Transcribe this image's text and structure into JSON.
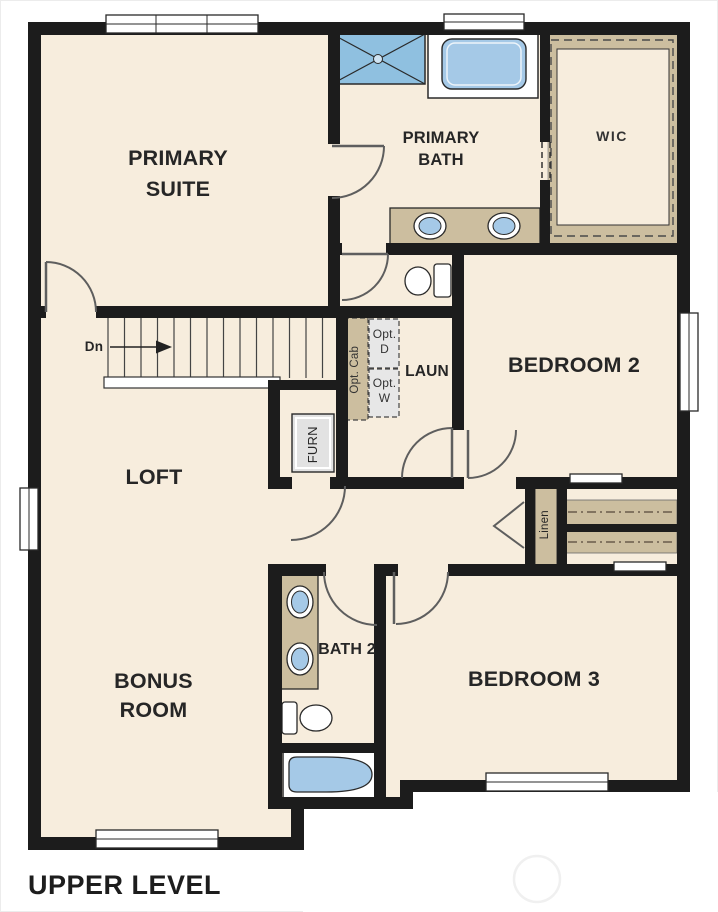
{
  "plan_title": "UPPER LEVEL",
  "rooms": {
    "primary_suite": "PRIMARY SUITE",
    "primary_bath": "PRIMARY BATH",
    "wic": "WIC",
    "bedroom_2": "BEDROOM 2",
    "laundry": "LAUN",
    "loft": "LOFT",
    "furnace_closet": "FURN",
    "linen_closet": "Linen",
    "bath_2": "BATH 2",
    "bedroom_3": "BEDROOM 3",
    "bonus_room": "BONUS ROOM"
  },
  "annotations": {
    "stair_direction": "Dn",
    "optional_cabinets": "Opt. Cab",
    "optional_dryer": "Opt. D",
    "optional_washer": "Opt. W"
  },
  "colors": {
    "wall": "#1c1c1c",
    "floor": "#f7eddd",
    "casework_tan": "#ccbe9f",
    "fixture_blue": "#a5c9e7",
    "shower_blue": "#8fc0e0",
    "equipment_gray": "#e2e2e2",
    "text": "#262626"
  }
}
